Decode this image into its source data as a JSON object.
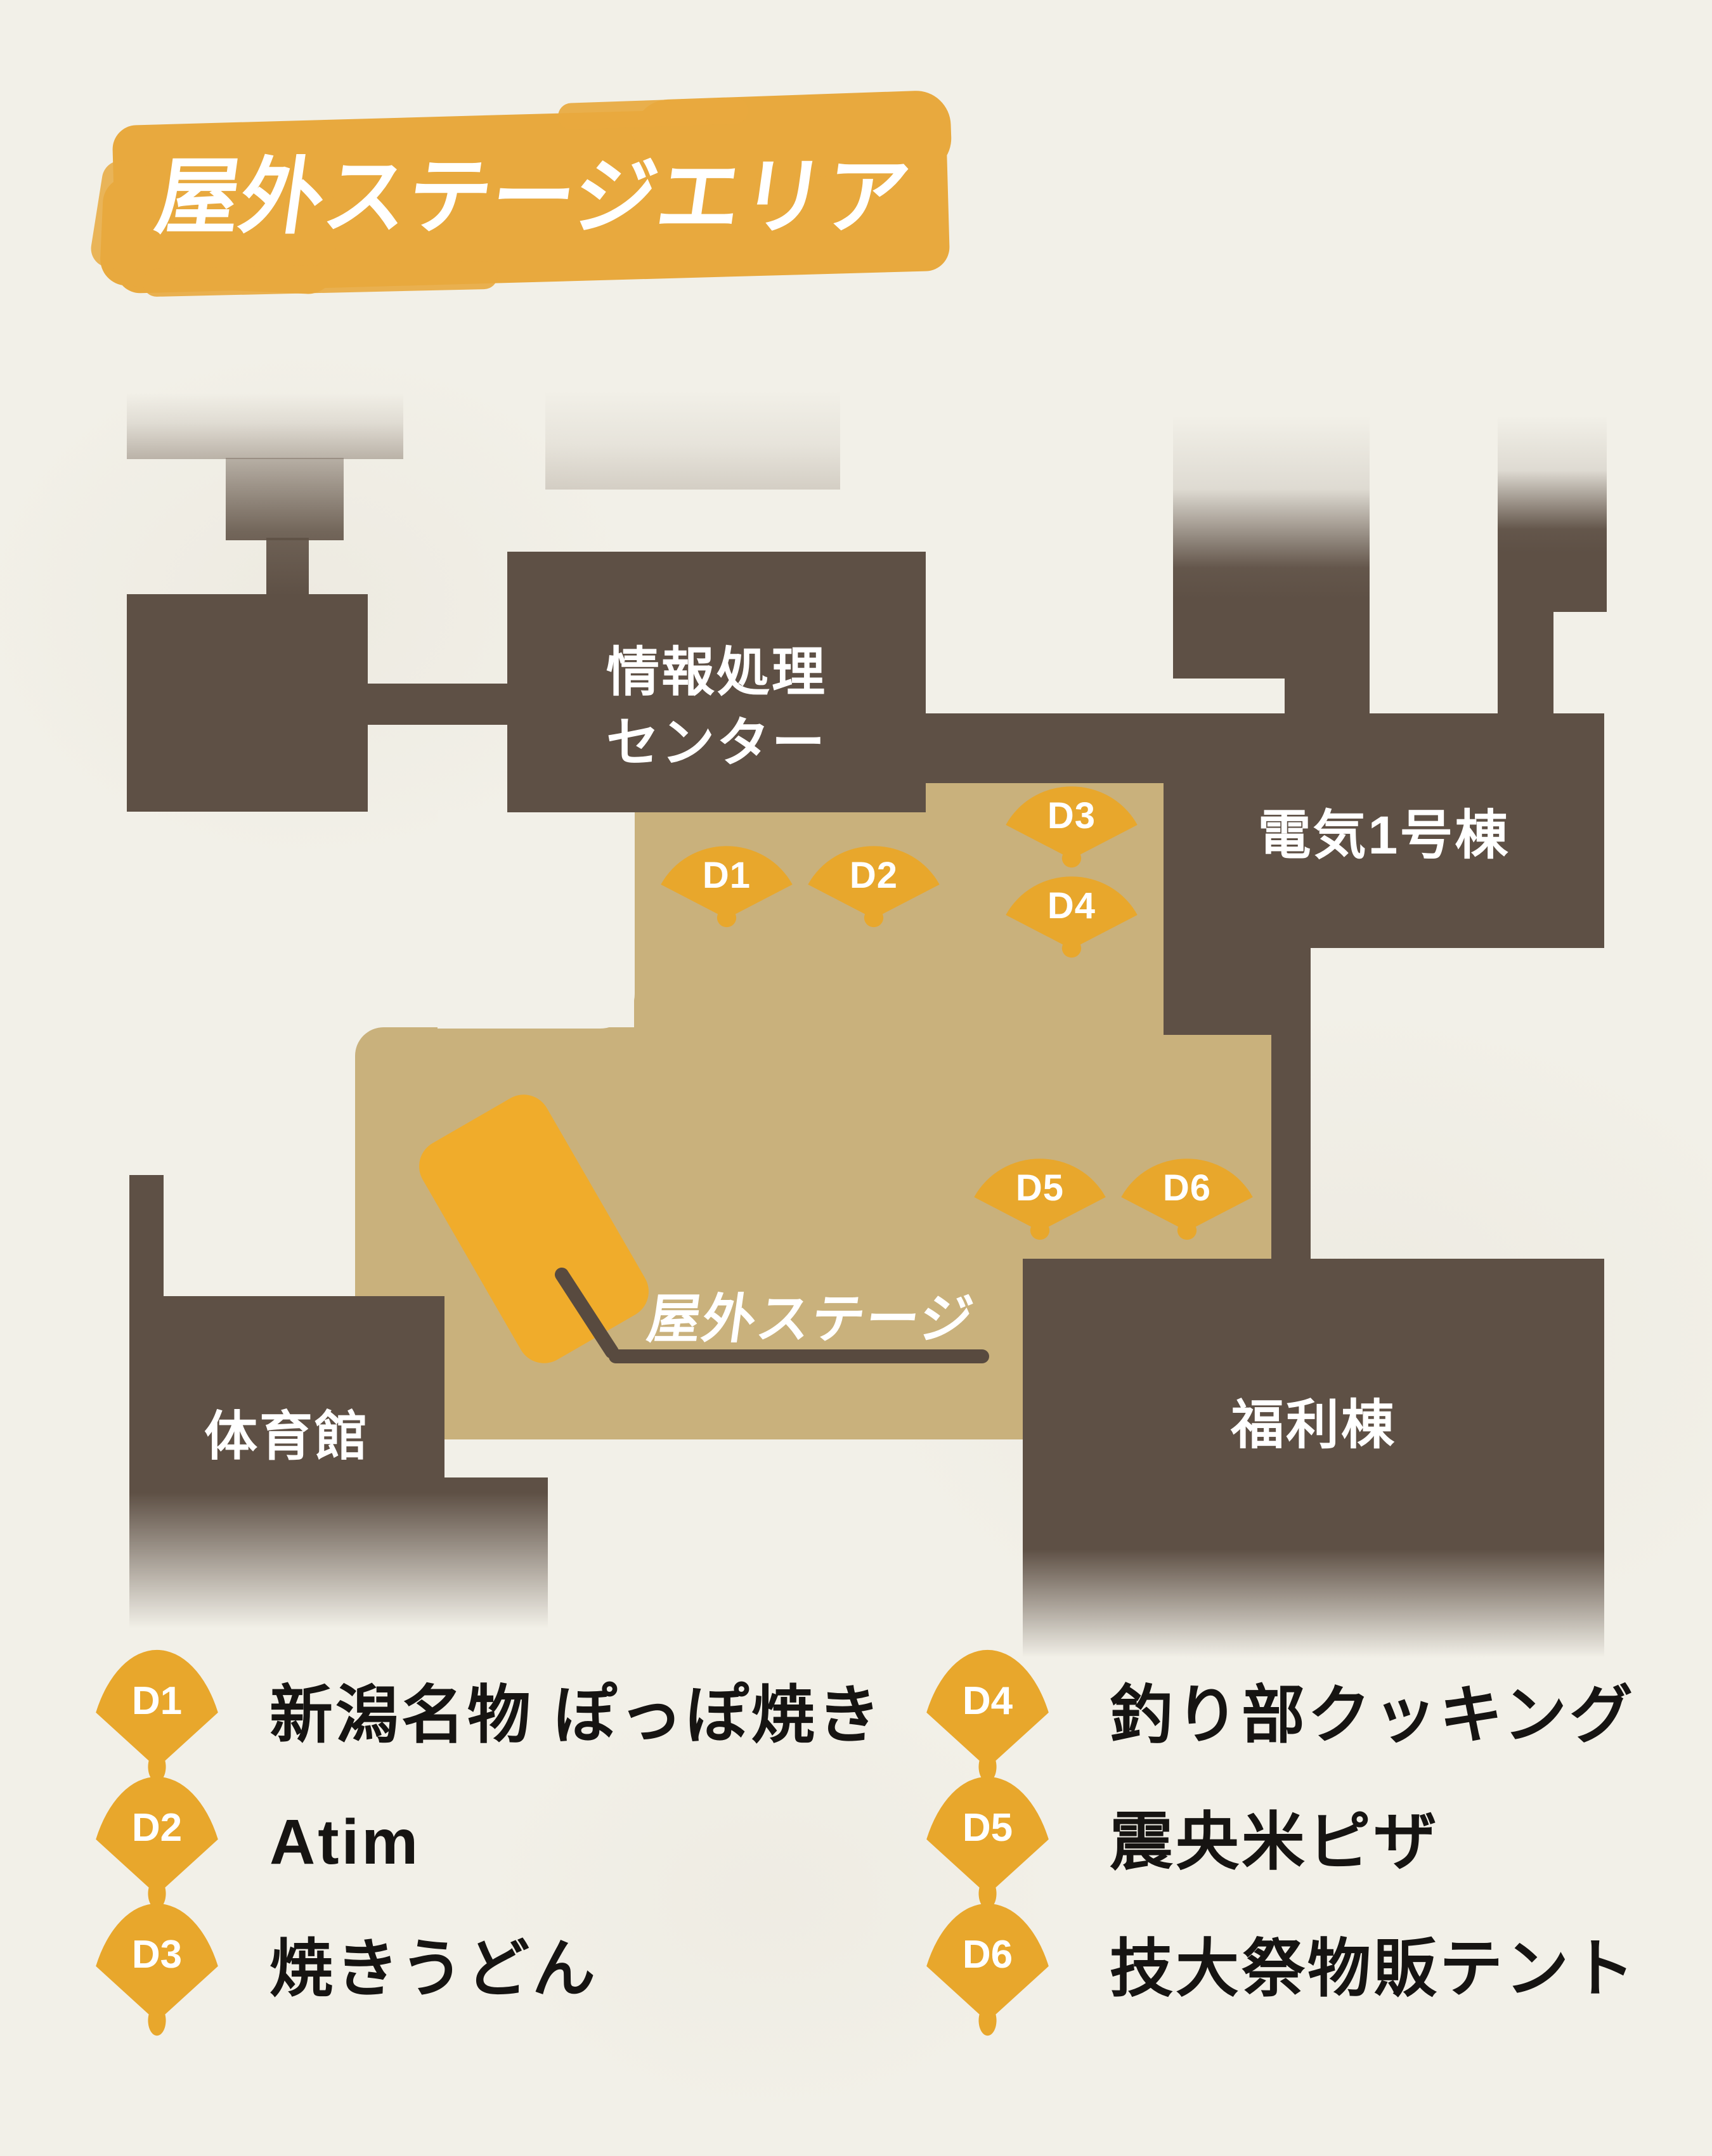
{
  "title": "屋外ステージエリア",
  "map": {
    "buildings": {
      "info_center": "情報処理\nセンター",
      "denki1": "電気1号棟",
      "gym": "体育館",
      "fukuri": "福利棟"
    },
    "stage_label": "屋外ステージ"
  },
  "booths": [
    {
      "id": "D1",
      "name": "新潟名物 ぽっぽ焼き"
    },
    {
      "id": "D2",
      "name": "Atim"
    },
    {
      "id": "D3",
      "name": "焼きうどん"
    },
    {
      "id": "D4",
      "name": "釣り部クッキング"
    },
    {
      "id": "D5",
      "name": "震央米ピザ"
    },
    {
      "id": "D6",
      "name": "技大祭物販テント"
    }
  ],
  "colors": {
    "paper": "#F2F0E8",
    "building_brown": "#5E5045",
    "plaza_tan": "#C9B17C",
    "fan_orange": "#E8A72C",
    "stage_orange": "#F0AC2B",
    "brush_orange": "#E8A93E",
    "leader_line": "#584A3F",
    "legend_text": "#161412",
    "label_text": "#FFFFFF"
  }
}
